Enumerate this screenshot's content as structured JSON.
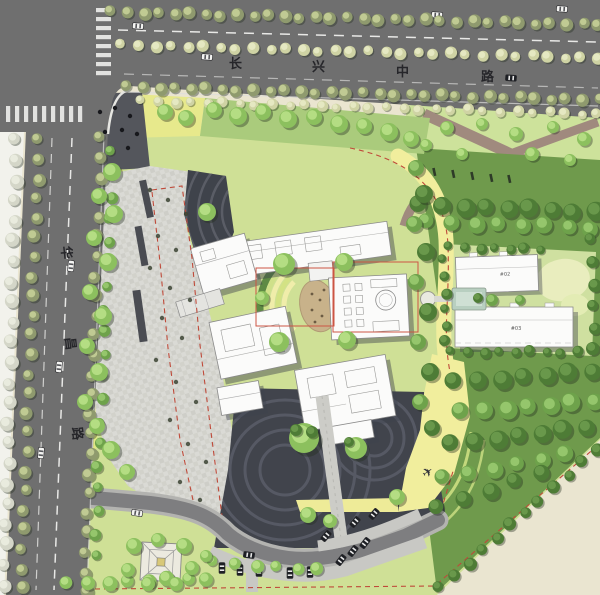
{
  "roads": {
    "north_road": {
      "name": "长兴中路",
      "chars": [
        "长",
        "兴",
        "中",
        "路"
      ]
    },
    "west_road": {
      "name": "华昌路",
      "chars": [
        "华",
        "昌",
        "路"
      ]
    }
  },
  "buildings": {
    "tower_a_label": "#02",
    "tower_b_label": "#03"
  },
  "icons": {
    "airplane_glyph": "✈",
    "car": "car-icon",
    "tree": "tree-icon",
    "pavilion": "pavilion-icon",
    "stone": "stone-icon",
    "pool": "pool-icon"
  },
  "colors": {
    "road_gray": "#6f6f6f",
    "plaza_dark": "#41444c",
    "paving_light": "#d8d8d3",
    "lawn_green": "#cfe096",
    "lawn_bright": "#e7e98c",
    "path_yellow": "#f1ee9d",
    "tree_green": "#7fb254",
    "tree_dark": "#4e7c36",
    "fire_lane_red": "#bf4a3a",
    "building_white": "#fbfbfa",
    "park_path_mauve": "#a08a7e",
    "open_beige": "#eae5d0"
  }
}
